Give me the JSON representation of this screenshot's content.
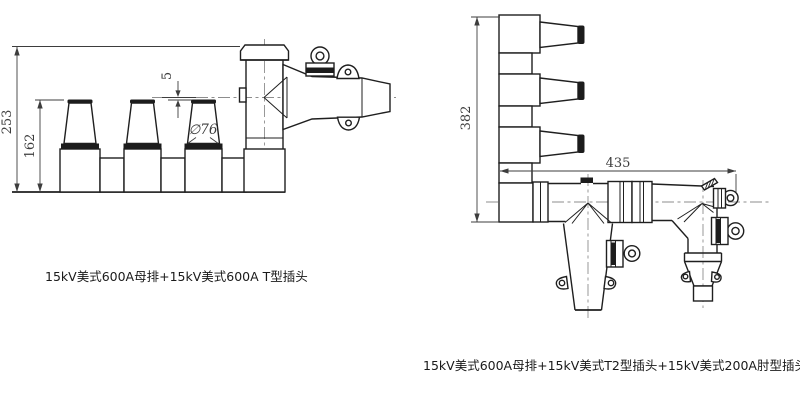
{
  "colors": {
    "background": "#ffffff",
    "line": "#1f1f1f",
    "dim": "#3d3d3d",
    "centerline": "#8d8d8d",
    "dark_fill": "#1c1c1c"
  },
  "figure_left": {
    "caption": "15kV美式600A母排+15kV美式600A T型插头",
    "dims": {
      "total_height": "253",
      "bushing_height": "162",
      "offset": "5",
      "diameter": "∅76"
    }
  },
  "figure_right": {
    "caption": "15kV美式600A母排+15kV美式T2型插头+15kV美式200A肘型插头",
    "dims": {
      "height": "382",
      "width": "435"
    }
  }
}
